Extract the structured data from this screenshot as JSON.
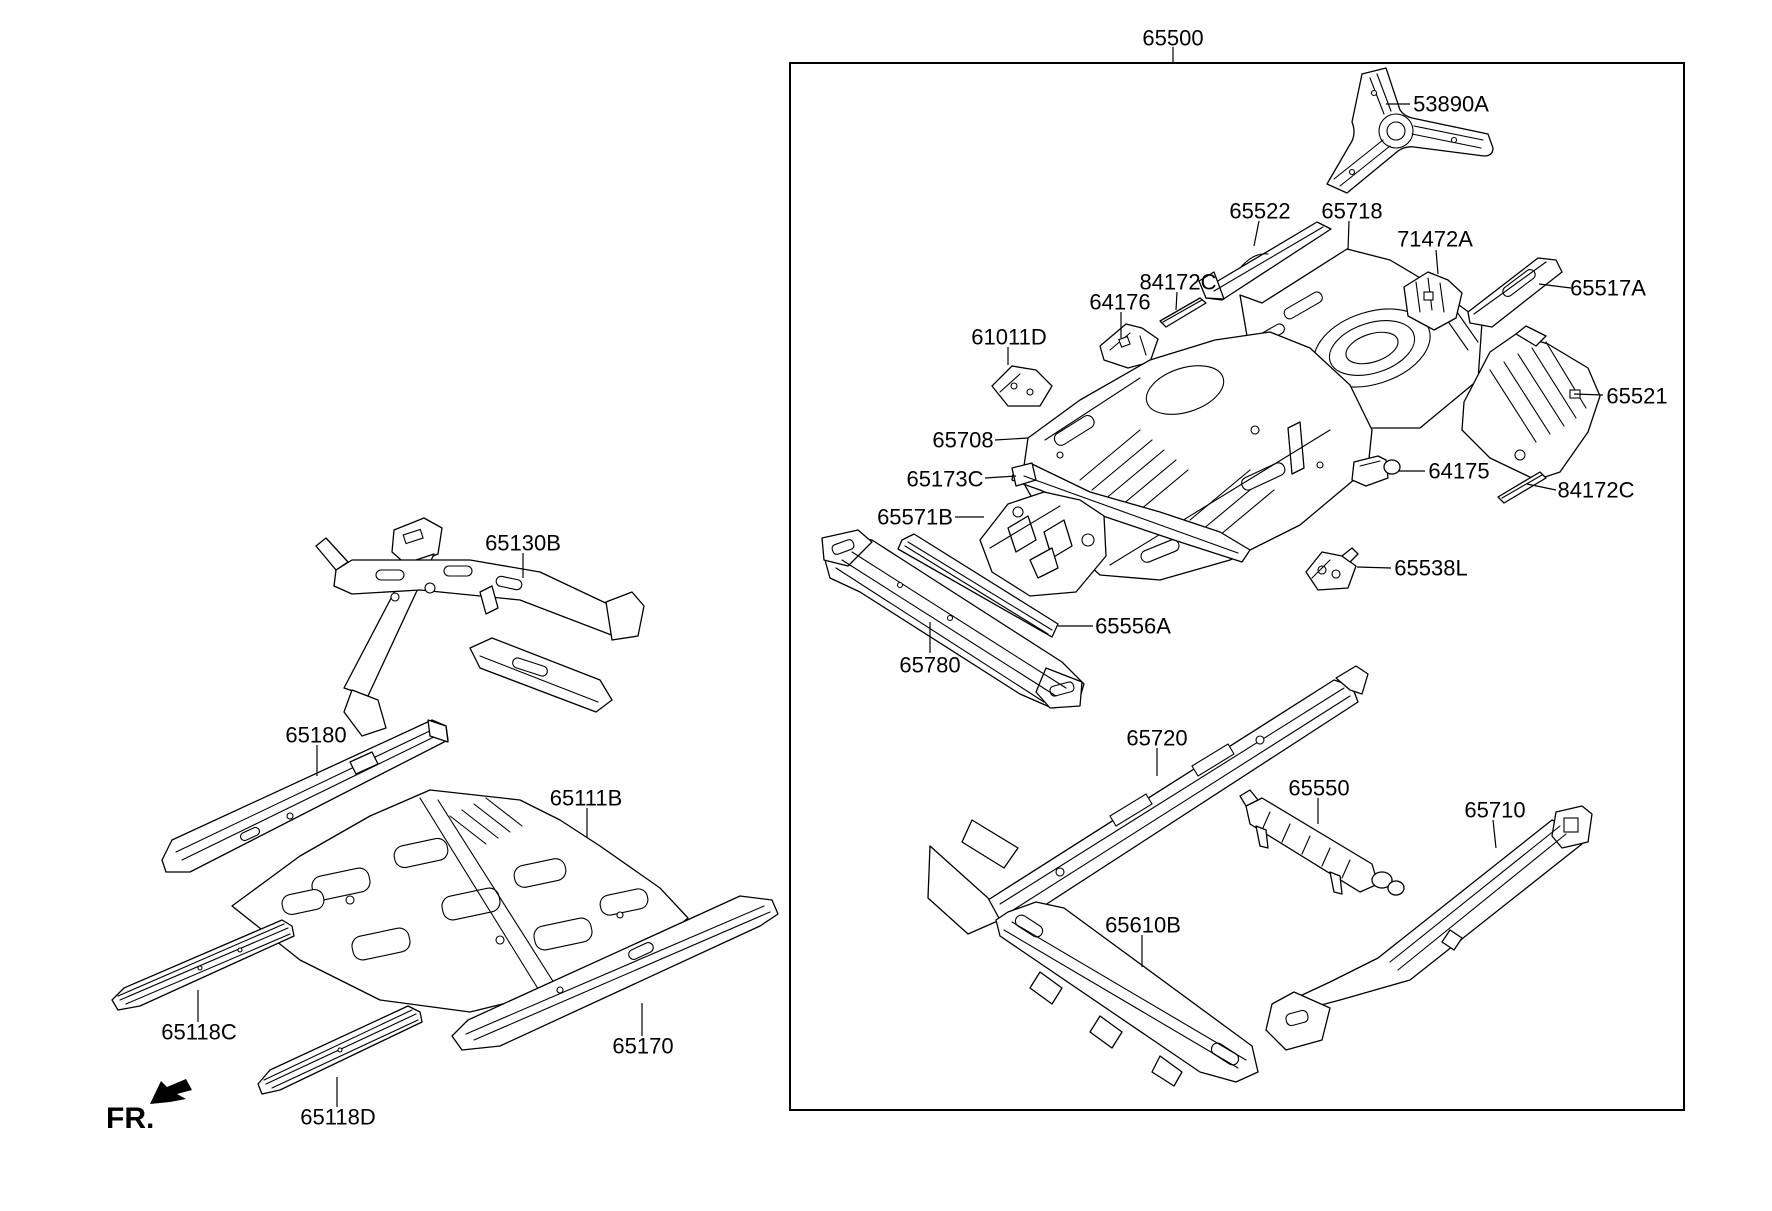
{
  "diagram": {
    "front_marker": "FR.",
    "assembly": {
      "part_no": "65500"
    },
    "loose_parts": [
      {
        "part_no": "65130B"
      },
      {
        "part_no": "65180"
      },
      {
        "part_no": "65111B"
      },
      {
        "part_no": "65118C"
      },
      {
        "part_no": "65170"
      },
      {
        "part_no": "65118D"
      }
    ],
    "assembly_parts": [
      {
        "part_no": "53890A"
      },
      {
        "part_no": "65522"
      },
      {
        "part_no": "65718"
      },
      {
        "part_no": "71472A"
      },
      {
        "part_no": "65517A"
      },
      {
        "part_no": "84172C"
      },
      {
        "part_no": "64176"
      },
      {
        "part_no": "61011D"
      },
      {
        "part_no": "65708"
      },
      {
        "part_no": "65173C"
      },
      {
        "part_no": "65571B"
      },
      {
        "part_no": "65556A"
      },
      {
        "part_no": "65780"
      },
      {
        "part_no": "64175"
      },
      {
        "part_no": "65521"
      },
      {
        "part_no": "84172C"
      },
      {
        "part_no": "65538L"
      },
      {
        "part_no": "65720"
      },
      {
        "part_no": "65550"
      },
      {
        "part_no": "65710"
      },
      {
        "part_no": "65610B"
      }
    ]
  },
  "colors": {
    "line": "#000000",
    "background": "#ffffff",
    "text": "#000000"
  }
}
